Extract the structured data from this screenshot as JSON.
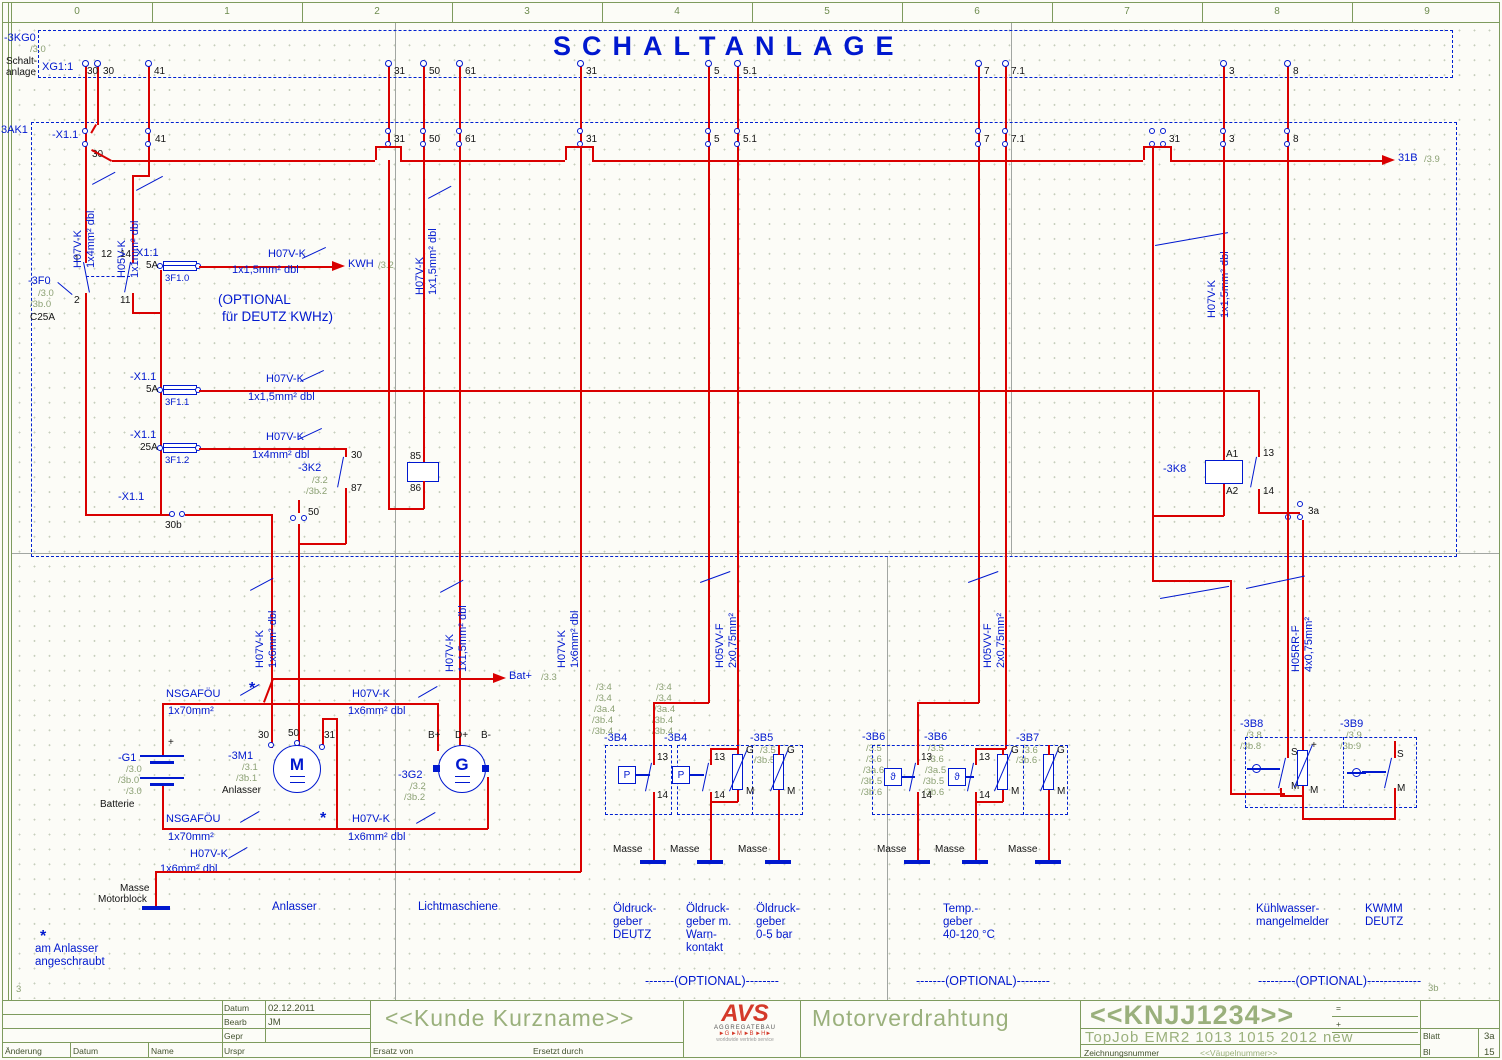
{
  "page": {
    "title": "SCHALTANLAGE",
    "ruler": [
      "0",
      "1",
      "2",
      "3",
      "4",
      "5",
      "6",
      "7",
      "8",
      "9"
    ],
    "ref_bl": "3",
    "ref_br": "3b"
  },
  "xg1": {
    "tag": "-3KG0",
    "ref": "/3.0",
    "desc1": "Schalt-",
    "desc2": "anlage",
    "name": "XG1:1",
    "t": [
      "30",
      "30",
      "41",
      "31",
      "50",
      "61",
      "31",
      "5",
      "5.1",
      "7",
      "7.1",
      "3",
      "8"
    ]
  },
  "ak1": {
    "tag": "3AK1",
    "strip": "-X1.1",
    "t": [
      "30",
      "41",
      "31",
      "50",
      "61",
      "31",
      "5",
      "5.1",
      "7",
      "7.1",
      "31",
      "3",
      "8"
    ]
  },
  "f0": {
    "tag": "-3F0",
    "r1": "/3.0",
    "r2": "/3b.0",
    "rating": "C25A",
    "p1": "1",
    "p2": "2",
    "p12": "12",
    "p14": "14",
    "p11": "11"
  },
  "fuse0": {
    "strip": "X1:1",
    "amp": "5A",
    "tag": "3F1.0"
  },
  "fuse1": {
    "strip": "-X1.1",
    "amp": "5A",
    "tag": "3F1.1"
  },
  "fuse2": {
    "strip": "-X1.1",
    "amp": "25A",
    "tag": "3F1.2"
  },
  "x30b": {
    "strip": "-X1.1",
    "pin": "30b"
  },
  "plug50": "50",
  "plug3a": "3a",
  "k2": {
    "tag": "-3K2",
    "r1": "/3.2",
    "r2": "/3b.2",
    "c30": "30",
    "c87": "87",
    "c85": "85",
    "c86": "86"
  },
  "k8": {
    "tag": "-3K8",
    "a1": "A1",
    "a2": "A2",
    "c13": "13",
    "c14": "14"
  },
  "arrow_kwh": {
    "label": "KWH",
    "ref": "/3.2"
  },
  "arrow_bat": {
    "label": "Bat+",
    "ref": "/3.3"
  },
  "arrow_31b": {
    "label": "31B",
    "ref": "/3.9"
  },
  "opt1": "(OPTIONAL",
  "opt2": "für DEUTZ KWHz)",
  "w": {
    "h07": "H07V-K",
    "h05v": "H05V-K",
    "h05vv": "H05VV-F",
    "h05rr": "H05RR-F",
    "nsga": "NSGAFÖU",
    "s4": "1x4mm² dbl",
    "s1": "1x1mm² dbl",
    "s15": "1x1,5mm² dbl",
    "s6": "1x6mm² dbl",
    "s70": "1x70mm²",
    "s2075": "2x0,75mm²",
    "s4075": "4x0,75mm²"
  },
  "star": "*",
  "g1": {
    "tag": "-G1",
    "r1": "/3.0",
    "r2": "/3b.0",
    "r3": "/3.0",
    "name": "Batterie",
    "plus": "+"
  },
  "m1": {
    "tag": "-3M1",
    "r1": "/3.1",
    "r2": "/3b.1",
    "name": "Anlasser",
    "sym": "M",
    "t30": "30",
    "t50": "50",
    "t31": "31"
  },
  "g2": {
    "tag": "-3G2",
    "r1": "/3.2",
    "r2": "/3b.2",
    "sym": "G",
    "bp": "B+",
    "dp": "D+",
    "bm": "B-"
  },
  "masse": "Masse",
  "mb1": "Masse",
  "mb2": "Motorblock",
  "b4a": {
    "tag": "-3B4",
    "refs": [
      "/3.4",
      "/3.4",
      "/3a.4",
      "/3b.4",
      "/3b.4"
    ],
    "sym": "P",
    "c13": "13",
    "c14": "14"
  },
  "b4b": {
    "tag": "-3B4",
    "refs": [
      "/3.4",
      "/3.4",
      "/3a.4",
      "/3b.4",
      "/3b.4"
    ],
    "sym": "P",
    "c13": "13",
    "c14": "14",
    "g": "G",
    "m": "M"
  },
  "b5": {
    "tag": "-3B5",
    "r1": "/3.5",
    "r2": "/3b.5",
    "g": "G",
    "m": "M"
  },
  "b6a": {
    "tag": "-3B6",
    "refs": [
      "/3.5",
      "/3.6",
      "/3a.6",
      "/3b.5",
      "/3b.6"
    ],
    "sym": "ϑ",
    "c13": "13",
    "c14": "14"
  },
  "b6b": {
    "tag": "-3B6",
    "refs": [
      "/3.5",
      "/3.6",
      "/3a.5",
      "/3b.5",
      "/3b.6"
    ],
    "sym": "ϑ",
    "c13": "13",
    "c14": "14",
    "g": "G",
    "m": "M"
  },
  "b7": {
    "tag": "-3B7",
    "r1": "/3.6",
    "r2": "/3b.6",
    "g": "G",
    "m": "M"
  },
  "b8": {
    "tag": "-3B8",
    "r1": "/3.8",
    "r2": "/3b.8",
    "s": "S",
    "m": "M",
    "rplus": "+",
    "rm": "M"
  },
  "b9": {
    "tag": "-3B9",
    "r1": "/3.9",
    "r2": "/3b.9",
    "s": "S",
    "m": "M"
  },
  "cap": {
    "anlasser": "Anlasser",
    "licht": "Lichtmaschiene",
    "o11": "Öldruck-",
    "o12": "geber",
    "o13": "DEUTZ",
    "o21": "Öldruck-",
    "o22": "geber m.",
    "o23": "Warn-",
    "o24": "kontakt",
    "o31": "Öldruck-",
    "o32": "geber",
    "o33": "0-5 bar",
    "t1": "Temp.-",
    "t2": "geber",
    "t3": "40-120 °C",
    "k1": "Kühlwasser-",
    "k2": "mangelmelder",
    "k3": "KWMM",
    "k4": "DEUTZ",
    "opt_a": "-------(OPTIONAL)--------",
    "opt_b": "-------(OPTIONAL)--------",
    "opt_c": "---------(OPTIONAL)-------------"
  },
  "note": {
    "star": "*",
    "l1": "am Anlasser",
    "l2": "angeschraubt"
  },
  "tb": {
    "datum_l": "Datum",
    "datum_v": "02.12.2011",
    "bearb_l": "Bearb",
    "bearb_v": "JM",
    "gepr_l": "Gepr",
    "urspr_l": "Urspr",
    "aend": "Änderung",
    "datum2": "Datum",
    "name2": "Name",
    "ersatz": "Ersatz von",
    "ersetzt": "Ersetzt durch",
    "kunde": "<<Kunde Kurzname>>",
    "proj": "Motorverdrahtung",
    "drawno": "<<KNJJ1234>>",
    "eq": "=",
    "plus": "+",
    "sysname": "TopJob EMR2 1013 1015 2012 new",
    "zeich": "Zeichnungsnummer",
    "vaupel": "<<Väupelnummer>>",
    "blatt_l": "Blatt",
    "blatt_v": "3a",
    "bl_l": "Bl",
    "bl_v": "15",
    "logo": "AVS",
    "logo2": "AGGREGATEBAU",
    "logo3": "►G ►M ►B ►H►",
    "logo4": "worldwide vertrieb service"
  }
}
